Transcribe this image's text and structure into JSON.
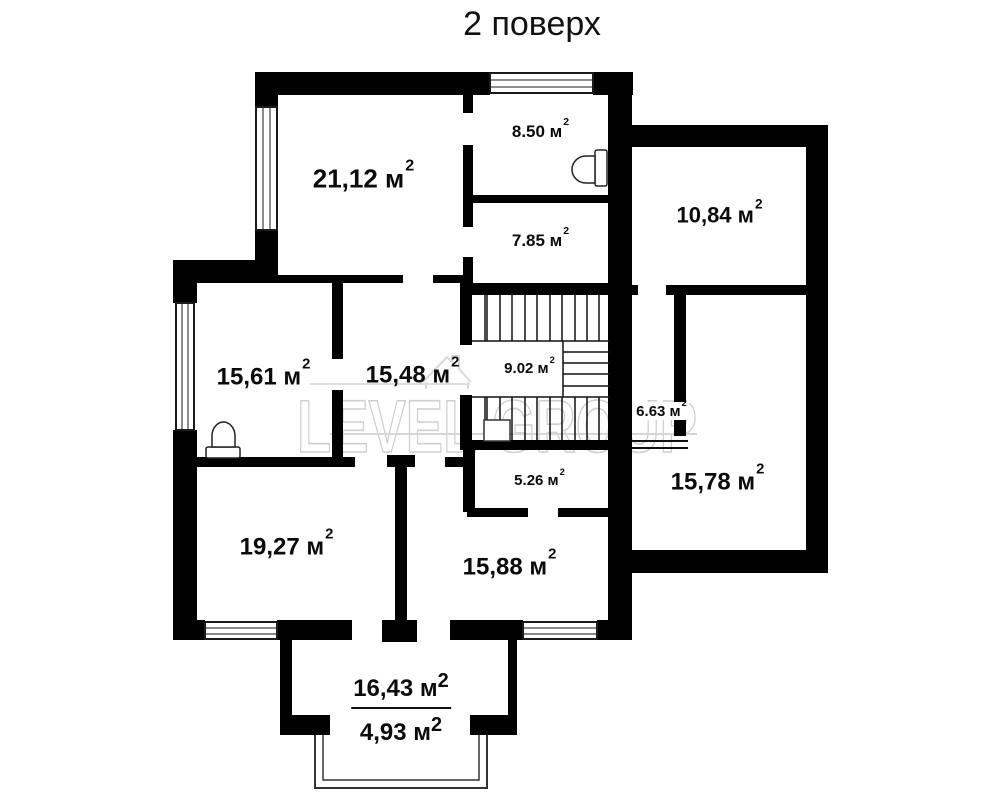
{
  "title": "2 поверх",
  "watermark": {
    "text": "LEVEL GROUP"
  },
  "area_sup": "2",
  "rooms": {
    "r2112": {
      "text": "21,12 м"
    },
    "r850": {
      "text": "8.50 м"
    },
    "r785": {
      "text": "7.85 м"
    },
    "r1084": {
      "text": "10,84 м"
    },
    "r1561": {
      "text": "15,61 м"
    },
    "r1548": {
      "text": "15,48 м"
    },
    "r902": {
      "text": "9.02 м"
    },
    "r663": {
      "text": "6.63 м"
    },
    "r1578": {
      "text": "15,78 м"
    },
    "r526": {
      "text": "5.26 м"
    },
    "r1927": {
      "text": "19,27 м"
    },
    "r1588": {
      "text": "15,88 м"
    },
    "terrace": {
      "text": "16,43 м"
    },
    "balcony": {
      "text": "4,93 м"
    }
  }
}
